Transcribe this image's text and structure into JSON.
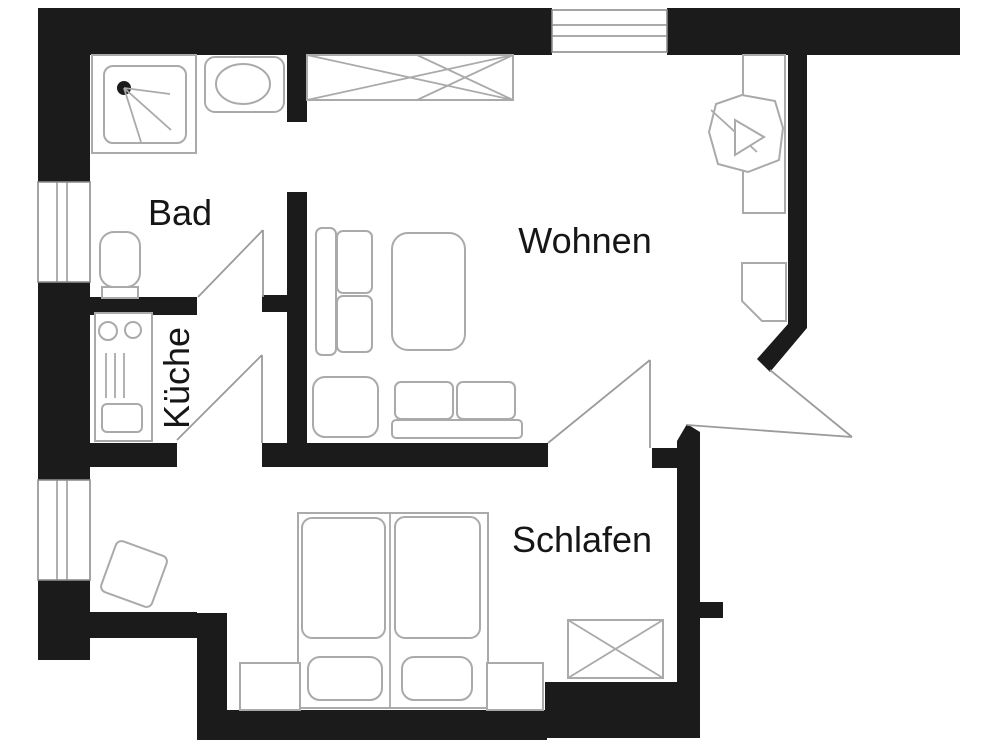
{
  "document": {
    "type": "floor-plan",
    "language": "de"
  },
  "colors": {
    "wall": "#1b1b1b",
    "furniture_outline": "#aaaaaa",
    "door_swing": "#9b9b9b",
    "label_text": "#161616",
    "background": "#ffffff"
  },
  "rooms": {
    "bathroom": {
      "label": "Bad"
    },
    "kitchen": {
      "label": "Küche"
    },
    "living_room": {
      "label": "Wohnen"
    },
    "bedroom": {
      "label": "Schlafen"
    }
  }
}
